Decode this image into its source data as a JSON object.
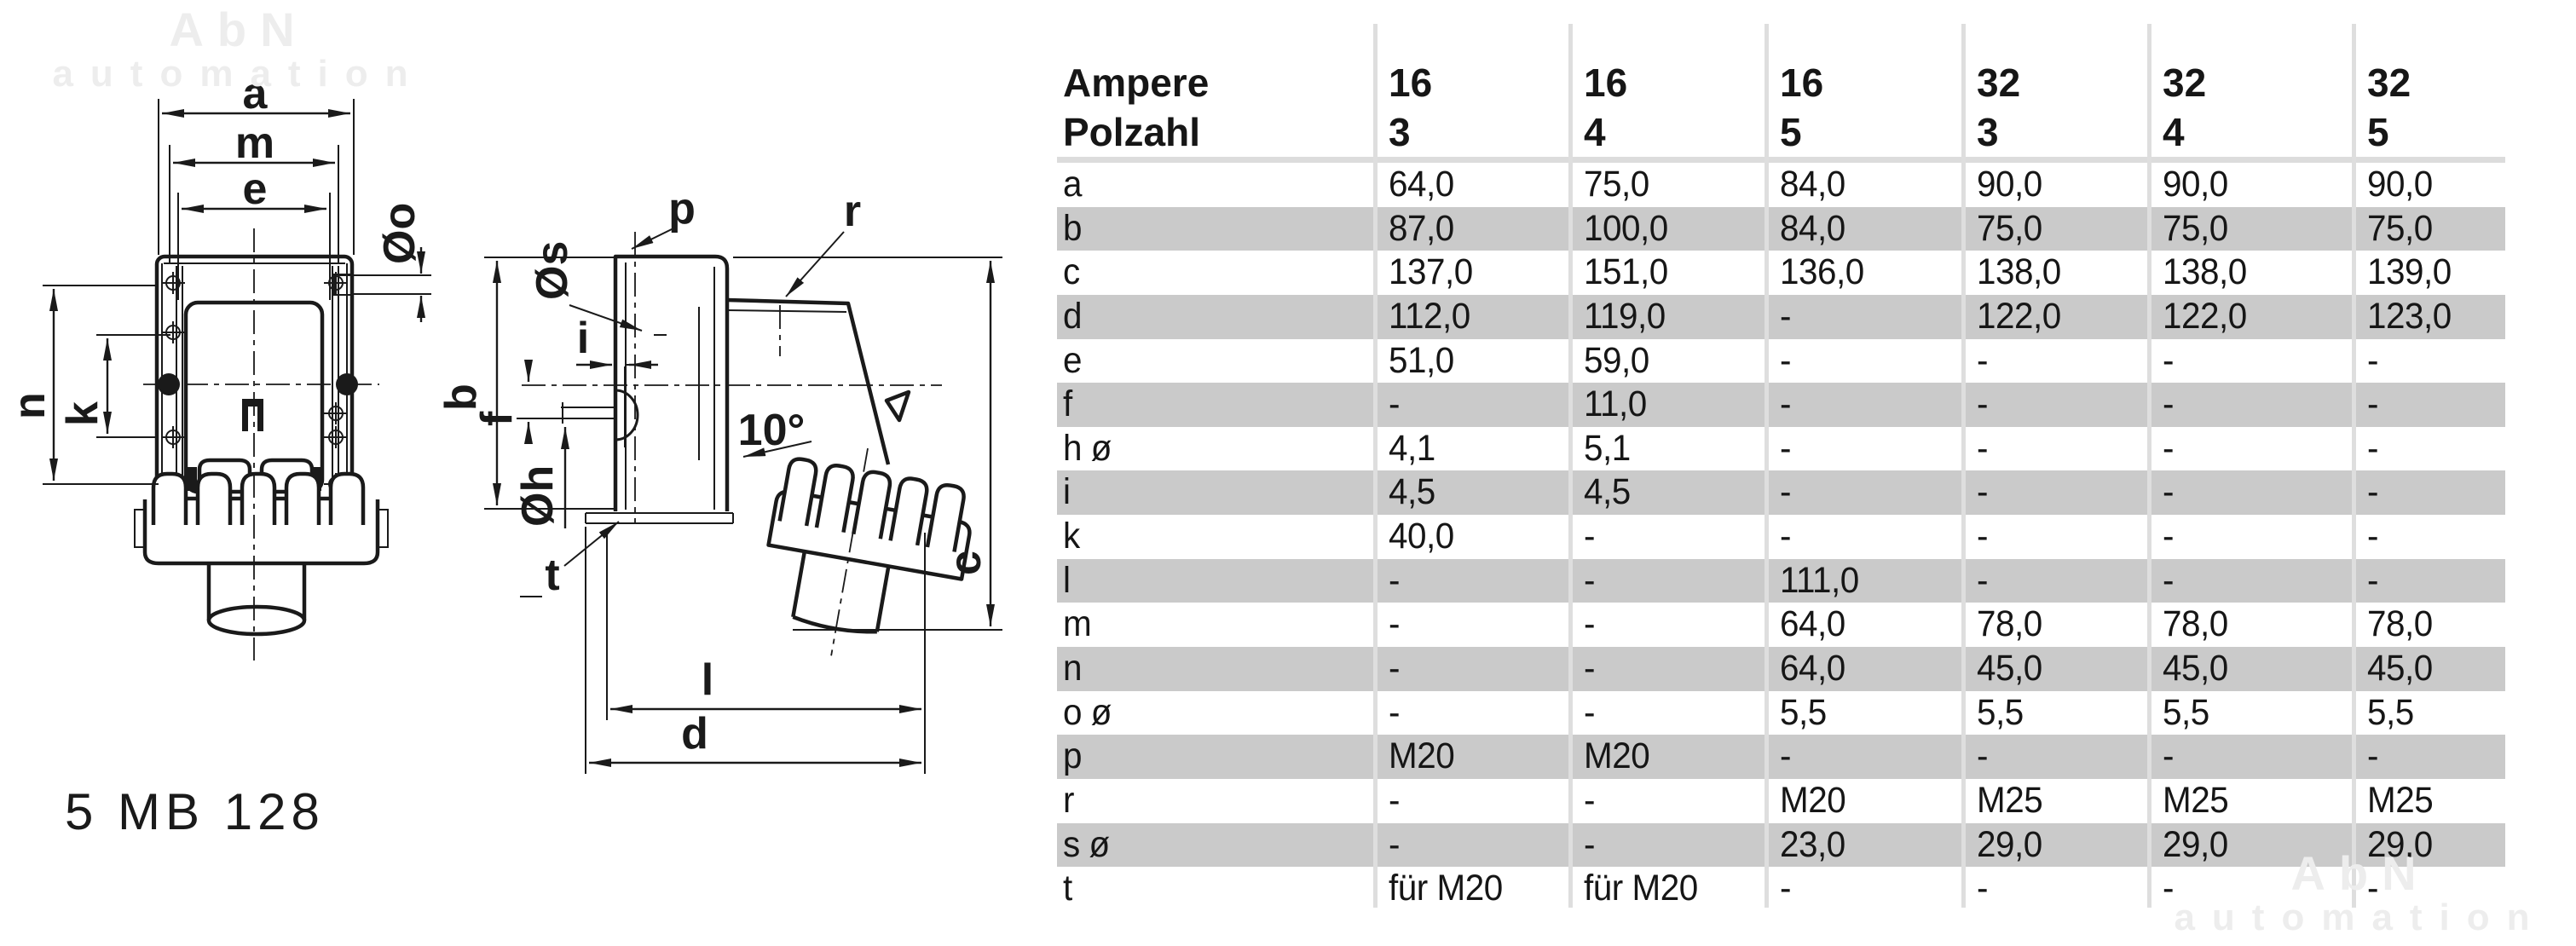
{
  "watermark": {
    "line1": "AbN",
    "line2": "automation"
  },
  "part_number": "5 MB 128",
  "drawing": {
    "labels": {
      "a": "a",
      "m": "m",
      "e": "e",
      "oo": "Øo",
      "n": "n",
      "k": "k",
      "b": "b",
      "os": "Øs",
      "p": "p",
      "r": "r",
      "i": "i",
      "f": "f",
      "oh": "Øh",
      "angle": "10°",
      "c": "c",
      "t": "t",
      "l": "l",
      "d": "d"
    }
  },
  "table": {
    "header": [
      {
        "label": "Ampere",
        "values": [
          "16",
          "16",
          "16",
          "32",
          "32",
          "32"
        ]
      },
      {
        "label": "Polzahl",
        "values": [
          "3",
          "4",
          "5",
          "3",
          "4",
          "5"
        ]
      }
    ],
    "rows": [
      {
        "label": "a",
        "values": [
          "64,0",
          "75,0",
          "84,0",
          "90,0",
          "90,0",
          "90,0"
        ]
      },
      {
        "label": "b",
        "values": [
          "87,0",
          "100,0",
          "84,0",
          "75,0",
          "75,0",
          "75,0"
        ]
      },
      {
        "label": "c",
        "values": [
          "137,0",
          "151,0",
          "136,0",
          "138,0",
          "138,0",
          "139,0"
        ]
      },
      {
        "label": "d",
        "values": [
          "112,0",
          "119,0",
          "-",
          "122,0",
          "122,0",
          "123,0"
        ]
      },
      {
        "label": "e",
        "values": [
          "51,0",
          "59,0",
          "-",
          "-",
          "-",
          "-"
        ]
      },
      {
        "label": "f",
        "values": [
          "-",
          "11,0",
          "-",
          "-",
          "-",
          "-"
        ]
      },
      {
        "label": "h ø",
        "values": [
          "4,1",
          "5,1",
          "-",
          "-",
          "-",
          "-"
        ]
      },
      {
        "label": "i",
        "values": [
          "4,5",
          "4,5",
          "-",
          "-",
          "-",
          "-"
        ]
      },
      {
        "label": "k",
        "values": [
          "40,0",
          "-",
          "-",
          "-",
          "-",
          "-"
        ]
      },
      {
        "label": "l",
        "values": [
          "-",
          "-",
          "111,0",
          "-",
          "-",
          "-"
        ]
      },
      {
        "label": "m",
        "values": [
          "-",
          "-",
          "64,0",
          "78,0",
          "78,0",
          "78,0"
        ]
      },
      {
        "label": "n",
        "values": [
          "-",
          "-",
          "64,0",
          "45,0",
          "45,0",
          "45,0"
        ]
      },
      {
        "label": "o ø",
        "values": [
          "-",
          "-",
          "5,5",
          "5,5",
          "5,5",
          "5,5"
        ]
      },
      {
        "label": "p",
        "values": [
          "M20",
          "M20",
          "-",
          "-",
          "-",
          "-"
        ]
      },
      {
        "label": "r",
        "values": [
          "-",
          "-",
          "M20",
          "M25",
          "M25",
          "M25"
        ]
      },
      {
        "label": "s ø",
        "values": [
          "-",
          "-",
          "23,0",
          "29,0",
          "29,0",
          "29,0"
        ]
      },
      {
        "label": "t",
        "values": [
          "für M20",
          "für M20",
          "-",
          "-",
          "-",
          "-"
        ]
      }
    ]
  },
  "colors": {
    "stripe_gray": "#cacaca",
    "gridline": "#dedede",
    "separator": "#dcdcdc",
    "line": "#1a1a1a",
    "watermark": "#ededed"
  }
}
